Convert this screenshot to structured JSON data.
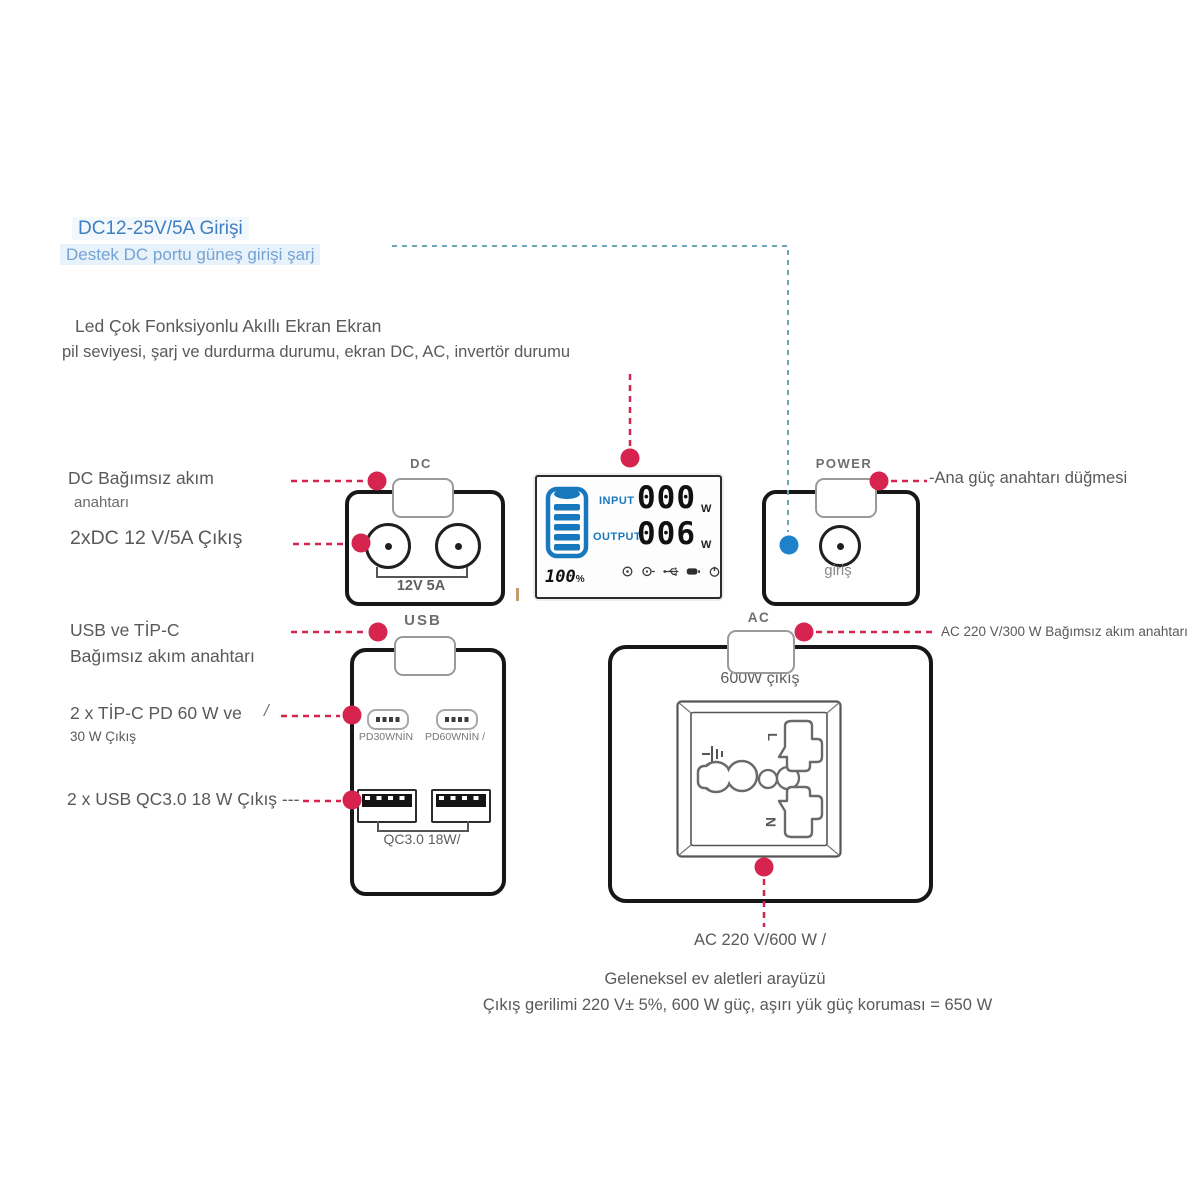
{
  "header": {
    "title": "DC12-25V/5A Girişi",
    "subtitle": "Destek DC portu güneş girişi şarj",
    "led_title": "Led Çok Fonksiyonlu Akıllı Ekran Ekran",
    "led_desc": "pil seviyesi, şarj ve durdurma durumu, ekran DC, AC, invertör durumu"
  },
  "left_labels": {
    "dc_switch_line1": "DC Bağımsız akım",
    "dc_switch_line2": "anahtarı",
    "dc_output": "2xDC 12 V/5A Çıkış",
    "usb_switch_line1": "USB ve TİP-C",
    "usb_switch_line2": "Bağımsız akım anahtarı",
    "typec_line1": "2 x TİP-C PD 60 W ve",
    "typec_line2": "30 W Çıkış",
    "typec_slash": "/",
    "usb_output": "2 x USB QC3.0 18 W Çıkış ---"
  },
  "right_labels": {
    "main_power": "-Ana güç anahtarı düğmesi",
    "ac_switch": "AC 220 V/300 W Bağımsız akım anahtarı"
  },
  "dc_module": {
    "name": "DC",
    "ports_label": "12V 5A"
  },
  "lcd": {
    "input_label": "INPUT",
    "input_value": "000",
    "input_unit": "W",
    "output_label": "OUTPUT",
    "output_value": "006",
    "output_unit": "W",
    "battery_level": "100",
    "battery_unit": "%"
  },
  "power_module": {
    "name": "POWER",
    "port_label": "giriş"
  },
  "usb_module": {
    "name": "USB",
    "typec_left_label": "PD30WNİN",
    "typec_right_label": "PD60WNİN /",
    "usba_label": "QC3.0 18W/"
  },
  "ac_module": {
    "name": "AC",
    "output_label": "600W çıkış",
    "live_label": "L",
    "neutral_label": "N",
    "bottom_label": "AC 220 V/600 W /"
  },
  "footer": {
    "line1": "Geleneksel ev aletleri arayüzü",
    "line2": "Çıkış gerilimi 220 V± 5%, 600 W güç, aşırı yük güç koruması = 650 W"
  },
  "colors": {
    "accent_red": "#d6244e",
    "accent_blue": "#1e82cb",
    "teal_line": "#6da6b2",
    "text_gray": "#595959",
    "lcd_blue": "#1878be",
    "title_blue": "#3f7fc1",
    "subtitle_blue": "#74a3d4"
  }
}
